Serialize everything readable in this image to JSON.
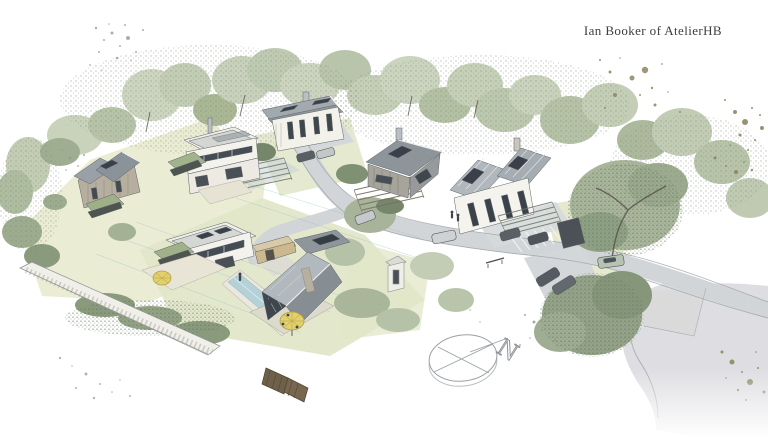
{
  "credit": {
    "text": "Ian Booker of AtelierHB"
  },
  "compass": {
    "north_label": "N"
  },
  "palette": {
    "page_background": "#ffffff",
    "foliage_light": "#c9d2bb",
    "foliage_mid": "#a9b69b",
    "foliage_dark": "#7e8f74",
    "lawn_green": "#e3e8c9",
    "road_gray": "#d3d6d8",
    "road_wash": "#d8d7dc",
    "roof_gray": "#98a0a6",
    "wall_white": "#f3f2ec",
    "window_dark": "#434a52",
    "solar_panel_dark": "#39404a",
    "pool_blue": "#b5d2d8",
    "umbrella_yellow": "#e3cf6b",
    "stone_wall": "#efeee9",
    "fence_brown": "#6f6049",
    "speckle_olive": "#8d8560",
    "guide_line_cyan": "#7fb6c0",
    "credit_text": "#3c3e40"
  }
}
